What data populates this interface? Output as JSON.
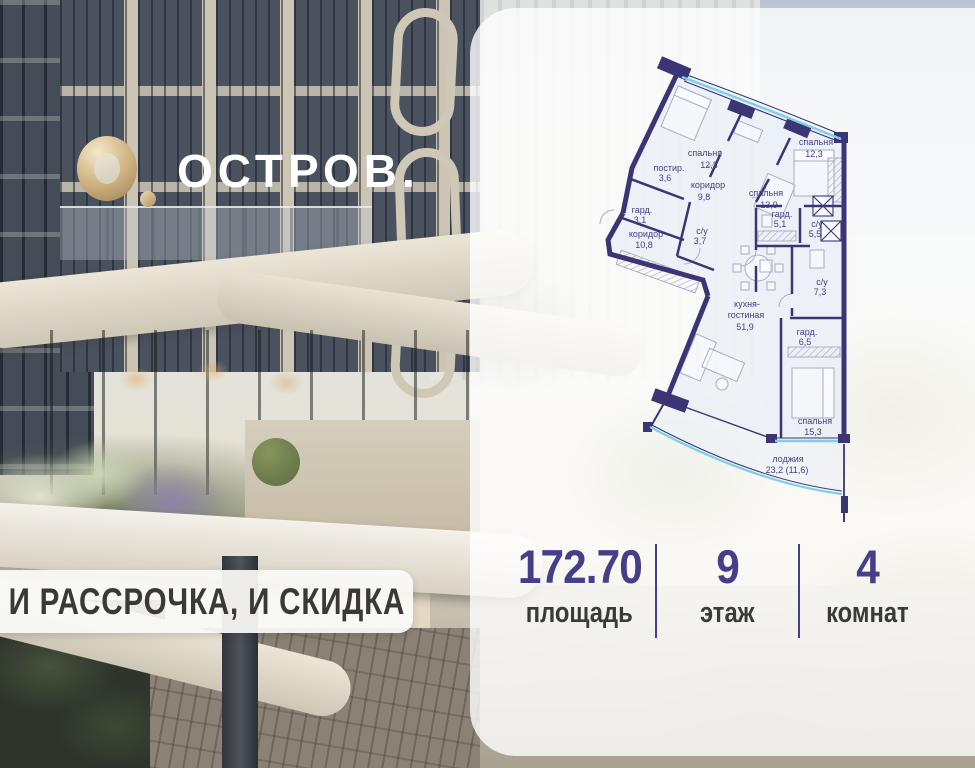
{
  "brand": {
    "logo_text": "ОСТРОВ."
  },
  "banner": {
    "text": "И РАССРОЧКА, И СКИДКА"
  },
  "floor_plan": {
    "wall_color": "#3b3576",
    "window_color": "#7fd0e6",
    "rooms": [
      {
        "lines": [
          "спальня",
          "12,3"
        ]
      },
      {
        "lines": [
          "спальня",
          "13,9"
        ]
      },
      {
        "lines": [
          "спальня",
          "12,3"
        ]
      },
      {
        "lines": [
          "постир.",
          "3,6"
        ]
      },
      {
        "lines": [
          "коридор",
          "9,8"
        ]
      },
      {
        "lines": [
          "гард.",
          "3,1"
        ]
      },
      {
        "lines": [
          "с/у",
          "3,7"
        ]
      },
      {
        "lines": [
          "коридор",
          "10,8"
        ]
      },
      {
        "lines": [
          "гард.",
          "5,1"
        ]
      },
      {
        "lines": [
          "с/у",
          "5,5"
        ]
      },
      {
        "lines": [
          "с/у",
          "7,3"
        ]
      },
      {
        "lines": [
          "кухня-",
          "гостиная",
          "51,9"
        ]
      },
      {
        "lines": [
          "гард.",
          "6,5"
        ]
      },
      {
        "lines": [
          "спальня",
          "15,3"
        ]
      },
      {
        "lines": [
          "лоджия",
          "23,2 (11,6)"
        ]
      }
    ]
  },
  "stats": {
    "accent_color": "#453f8a",
    "items": [
      {
        "value": "172.70",
        "label": "площадь"
      },
      {
        "value": "9",
        "label": "этаж"
      },
      {
        "value": "4",
        "label": "комнат"
      }
    ]
  }
}
